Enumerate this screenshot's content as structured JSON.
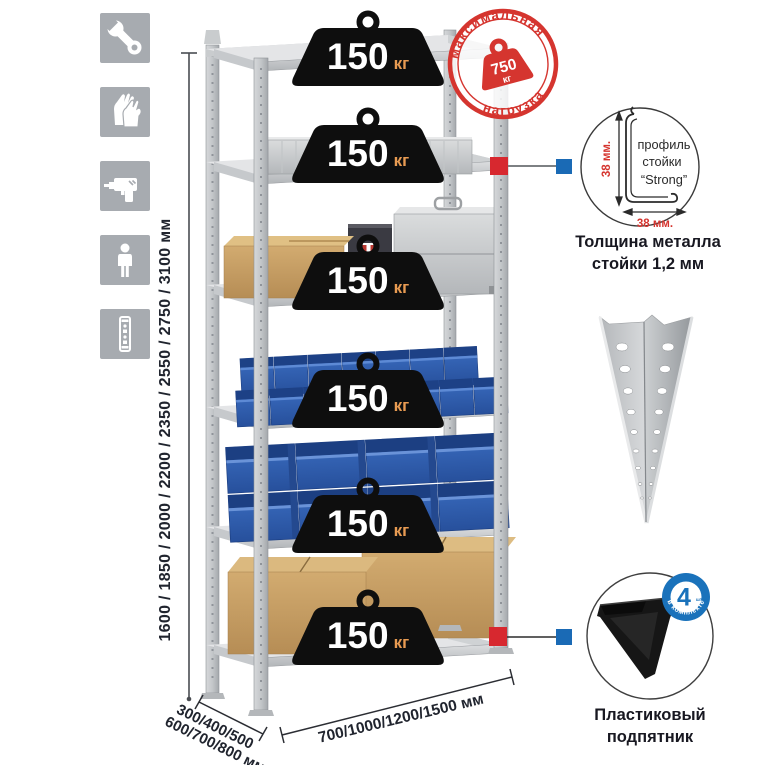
{
  "assembly_icons": [
    {
      "id": "wrench-icon"
    },
    {
      "id": "gloves-icon"
    },
    {
      "id": "drill-icon"
    },
    {
      "id": "person-icon"
    },
    {
      "id": "rack-profile-icon"
    }
  ],
  "rack": {
    "shelf_count": 6,
    "shelf_load_value": "150",
    "shelf_load_unit": "кг"
  },
  "max_load_stamp": {
    "arc_top": "максимальная",
    "arc_bottom": "нагрузка",
    "value": "750",
    "unit": "кг"
  },
  "dimensions": {
    "height_label": "1600 / 1850 / 2000 / 2200 / 2350 / 2550 / 2750 / 3100 мм",
    "depth_label_line1": "300/400/500",
    "depth_label_line2": "600/700/800 мм",
    "width_label": "700/1000/1200/1500 мм"
  },
  "profile_detail": {
    "label_line1": "профиль",
    "label_line2": "стойки",
    "label_line3": "“Strong”",
    "dim_vertical": "38 мм.",
    "dim_horizontal": "38 мм.",
    "caption_line1": "Толщина металла",
    "caption_line2": "стойки 1,2 мм"
  },
  "foot_detail": {
    "quantity": "4",
    "quantity_note": "штуки",
    "badge_arc": "в комплекте",
    "caption_line1": "Пластиковый",
    "caption_line2": "подпятник"
  },
  "colors": {
    "accent_red": "#d5352f",
    "marker_red": "#d7282f",
    "marker_blue": "#1a6ab5",
    "badge_black": "#0e0e0e",
    "unit_orange": "#e89b52",
    "icon_gray": "#a7abb0",
    "bins_blue": "#2e5fae",
    "text_dark": "#1b1b26"
  }
}
